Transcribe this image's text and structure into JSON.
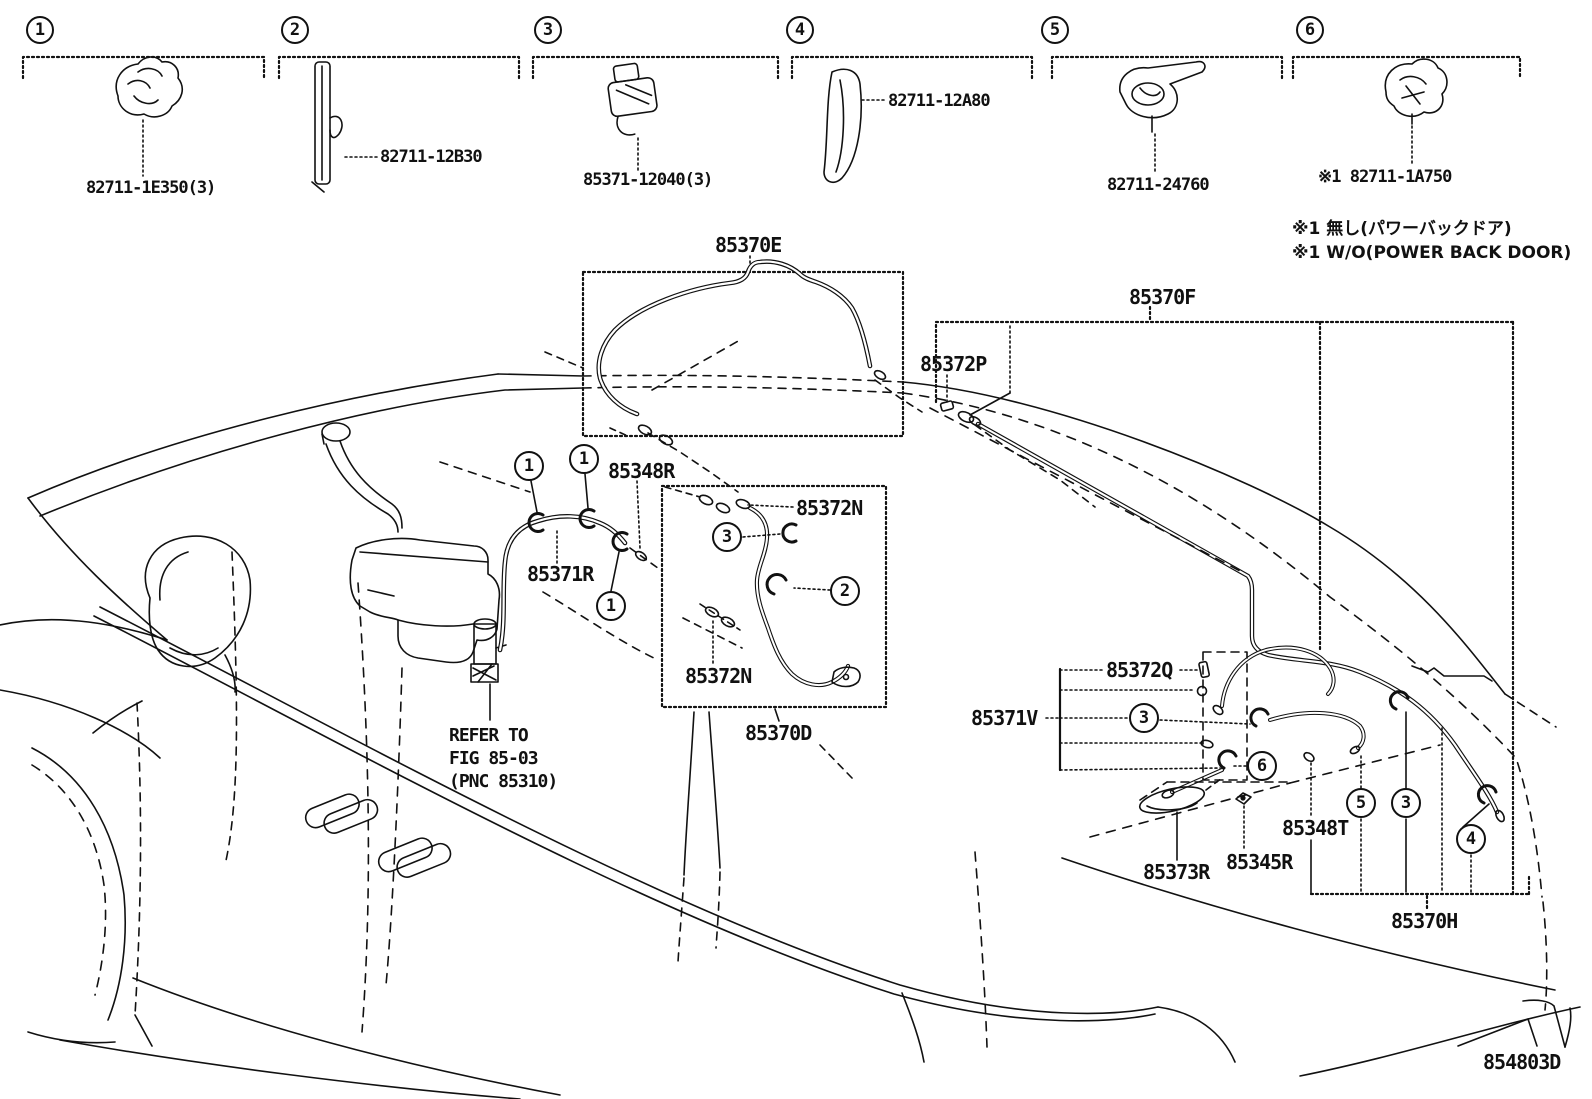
{
  "legend": {
    "items": [
      {
        "number": "1",
        "part": "82711-1E350(3)"
      },
      {
        "number": "2",
        "part": "82711-12B30"
      },
      {
        "number": "3",
        "part": "85371-12040(3)"
      },
      {
        "number": "4",
        "part": "82711-12A80"
      },
      {
        "number": "5",
        "part": "82711-24760"
      },
      {
        "number": "6",
        "part": "※1 82711-1A750"
      }
    ],
    "notes": [
      "※1 無し(パワーバックドア)",
      "※1 W/O(POWER BACK DOOR)"
    ]
  },
  "diagram": {
    "labels": {
      "hose_e": "85370E",
      "hose_f": "85370F",
      "p": "85372P",
      "r348": "85348R",
      "r371": "85371R",
      "n_top": "85372N",
      "n_bot": "85372N",
      "d": "85370D",
      "q": "85372Q",
      "v": "85371V",
      "r373": "85373R",
      "r345": "85345R",
      "t348": "85348T",
      "h": "85370H"
    },
    "refer_note": {
      "l1": "REFER TO",
      "l2": "FIG 85-03",
      "l3": "(PNC 85310)"
    },
    "callouts": [
      "1",
      "1",
      "1",
      "3",
      "2",
      "3",
      "6",
      "5",
      "3",
      "4"
    ],
    "drawing_number": "854803D"
  }
}
